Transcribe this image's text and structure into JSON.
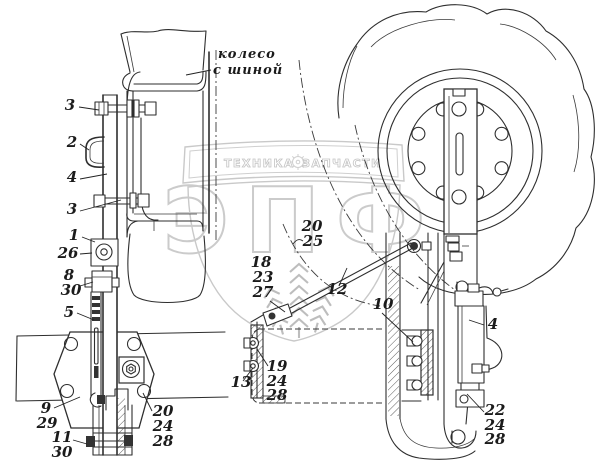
{
  "figure": {
    "note_line1": "колесо",
    "note_line2": "с шиной"
  },
  "watermark": {
    "banner_left": "ТЕХНИКА",
    "banner_right": "ЗАПЧАСТИ",
    "logo": "ЭПФ"
  },
  "callouts": [
    "3",
    "2",
    "4",
    "3",
    "1",
    "26",
    "8",
    "30",
    "5",
    "9",
    "29",
    "11",
    "30",
    "20",
    "24",
    "28",
    "20",
    "25",
    "18",
    "23",
    "27",
    "12",
    "13",
    "19",
    "24",
    "28",
    "10",
    "4",
    "22",
    "24",
    "28"
  ]
}
